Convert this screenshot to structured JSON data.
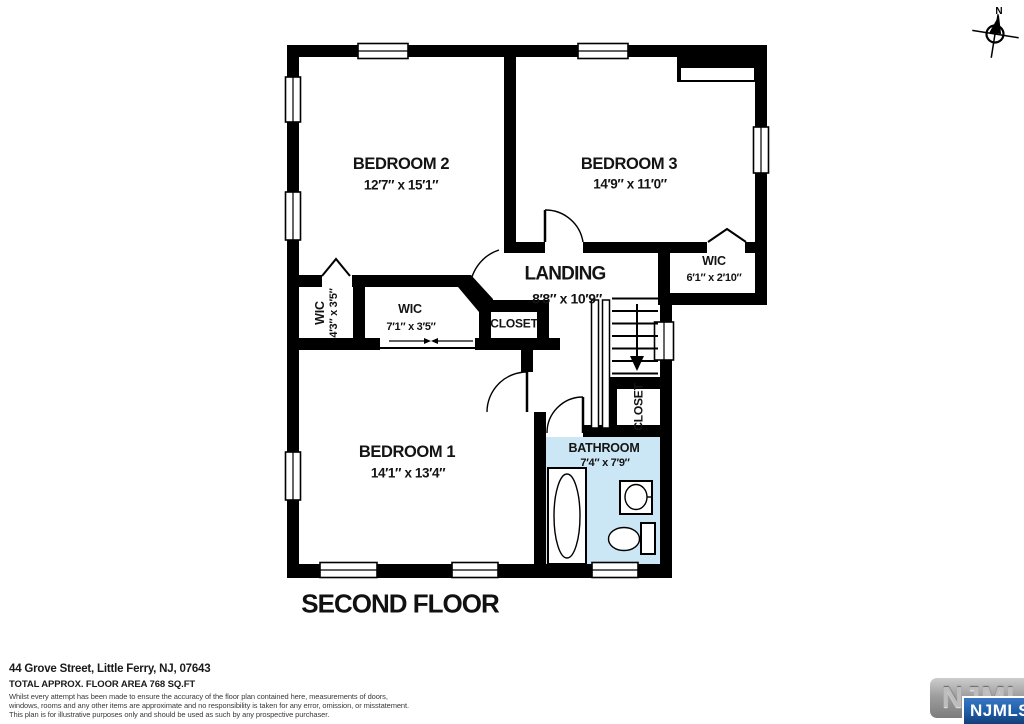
{
  "compass": {
    "label": "N"
  },
  "rooms": {
    "bedroom2": {
      "name": "BEDROOM 2",
      "dims": "12′7″ x 15′1″"
    },
    "bedroom3": {
      "name": "BEDROOM 3",
      "dims": "14′9″ x 11′0″"
    },
    "bedroom1": {
      "name": "BEDROOM 1",
      "dims": "14′1″ x 13′4″"
    },
    "landing": {
      "name": "LANDING",
      "dims": "8′8″ x 10′9″"
    },
    "bathroom": {
      "name": "BATHROOM",
      "dims": "7′4″ x 7′9″"
    },
    "wic_right": {
      "name": "WIC",
      "dims": "6′1″ x 2′10″"
    },
    "wic_left": {
      "name": "WIC",
      "dims": "4′3″ x 3′5″"
    },
    "wic_center": {
      "name": "WIC",
      "dims": "7′1″ x 3′5″"
    },
    "closet_landing": {
      "name": "CLOSET"
    },
    "closet_hall": {
      "name": "CLOSET"
    }
  },
  "floor_title": "SECOND FLOOR",
  "footer": {
    "address": "44 Grove Street, Little Ferry, NJ, 07643",
    "area": "TOTAL APPROX. FLOOR AREA 768 SQ.FT",
    "disclaimer_lines": [
      "Whilst every attempt has been made to ensure the accuracy of the floor plan contained here, measurements of doors,",
      "windows, rooms and any other items are approximate and no responsibility is taken for any error, omission, or misstatement.",
      "This plan is for illustrative purposes only and should be used as such by any prospective purchaser."
    ]
  },
  "logo": {
    "back_text": "NJMLS",
    "front_text": "NJMLS"
  },
  "colors": {
    "wall": "#000000",
    "bathroom_fill": "#CBE6F5",
    "logo_blue": "#1D5CA8",
    "logo_gray": "#9E9E9E"
  }
}
